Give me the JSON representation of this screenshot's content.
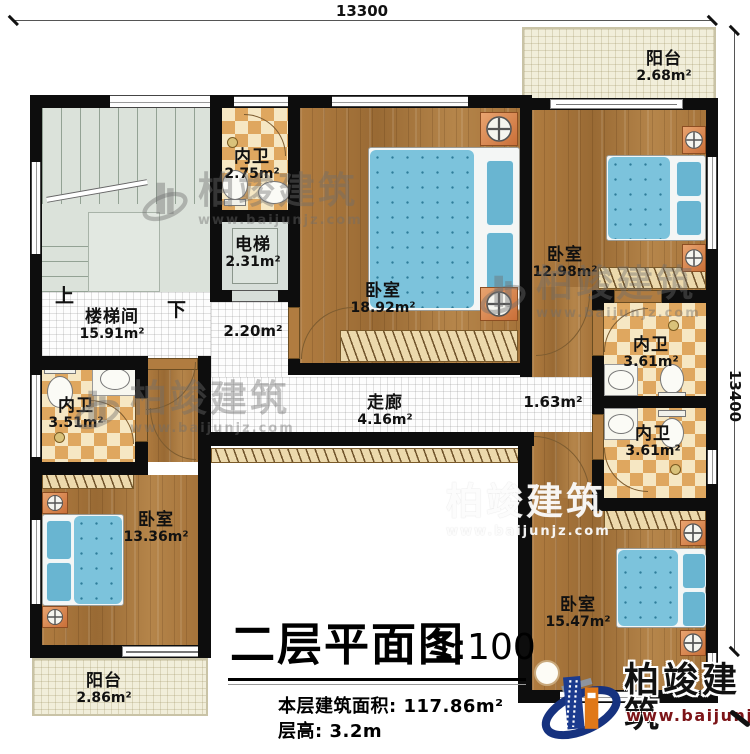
{
  "dimensions": {
    "top": "13300",
    "right": "13400"
  },
  "stairs": {
    "up": "上",
    "down": "下"
  },
  "rooms": [
    {
      "name": "阳台",
      "area": "2.68m²"
    },
    {
      "name": "卧室",
      "area": "12.98m²"
    },
    {
      "name": "内卫",
      "area": "2.75m²"
    },
    {
      "name": "电梯",
      "area": "2.31m²"
    },
    {
      "name": "楼梯间",
      "area": "15.91m²"
    },
    {
      "name": "卧室",
      "area": "18.92m²"
    },
    {
      "name": "",
      "area": "2.20m²"
    },
    {
      "name": "走廊",
      "area": "4.16m²"
    },
    {
      "name": "",
      "area": "1.63m²"
    },
    {
      "name": "内卫",
      "area": "3.61m²"
    },
    {
      "name": "内卫",
      "area": "3.61m²"
    },
    {
      "name": "内卫",
      "area": "3.51m²"
    },
    {
      "name": "卧室",
      "area": "13.36m²"
    },
    {
      "name": "卧室",
      "area": "15.47m²"
    },
    {
      "name": "阳台",
      "area": "2.86m²"
    }
  ],
  "title": {
    "main": "二层平面图",
    "scale": "1:100",
    "area_line": "本层建筑面积: 117.86m²",
    "height_line": "层高: 3.2m"
  },
  "brand": {
    "name": "柏竣建筑",
    "url": "www.baijunjz.com"
  },
  "colors": {
    "wall": "#0d0d0d",
    "wood": "#a9763c",
    "tile": "#dfa75f",
    "bed": "#7cc3dc",
    "stair": "#dbe2da",
    "balcony": "#f1eeda",
    "logo_blue": "#1c3b8e",
    "logo_orange": "#e07818",
    "url_red": "#7c1418"
  }
}
